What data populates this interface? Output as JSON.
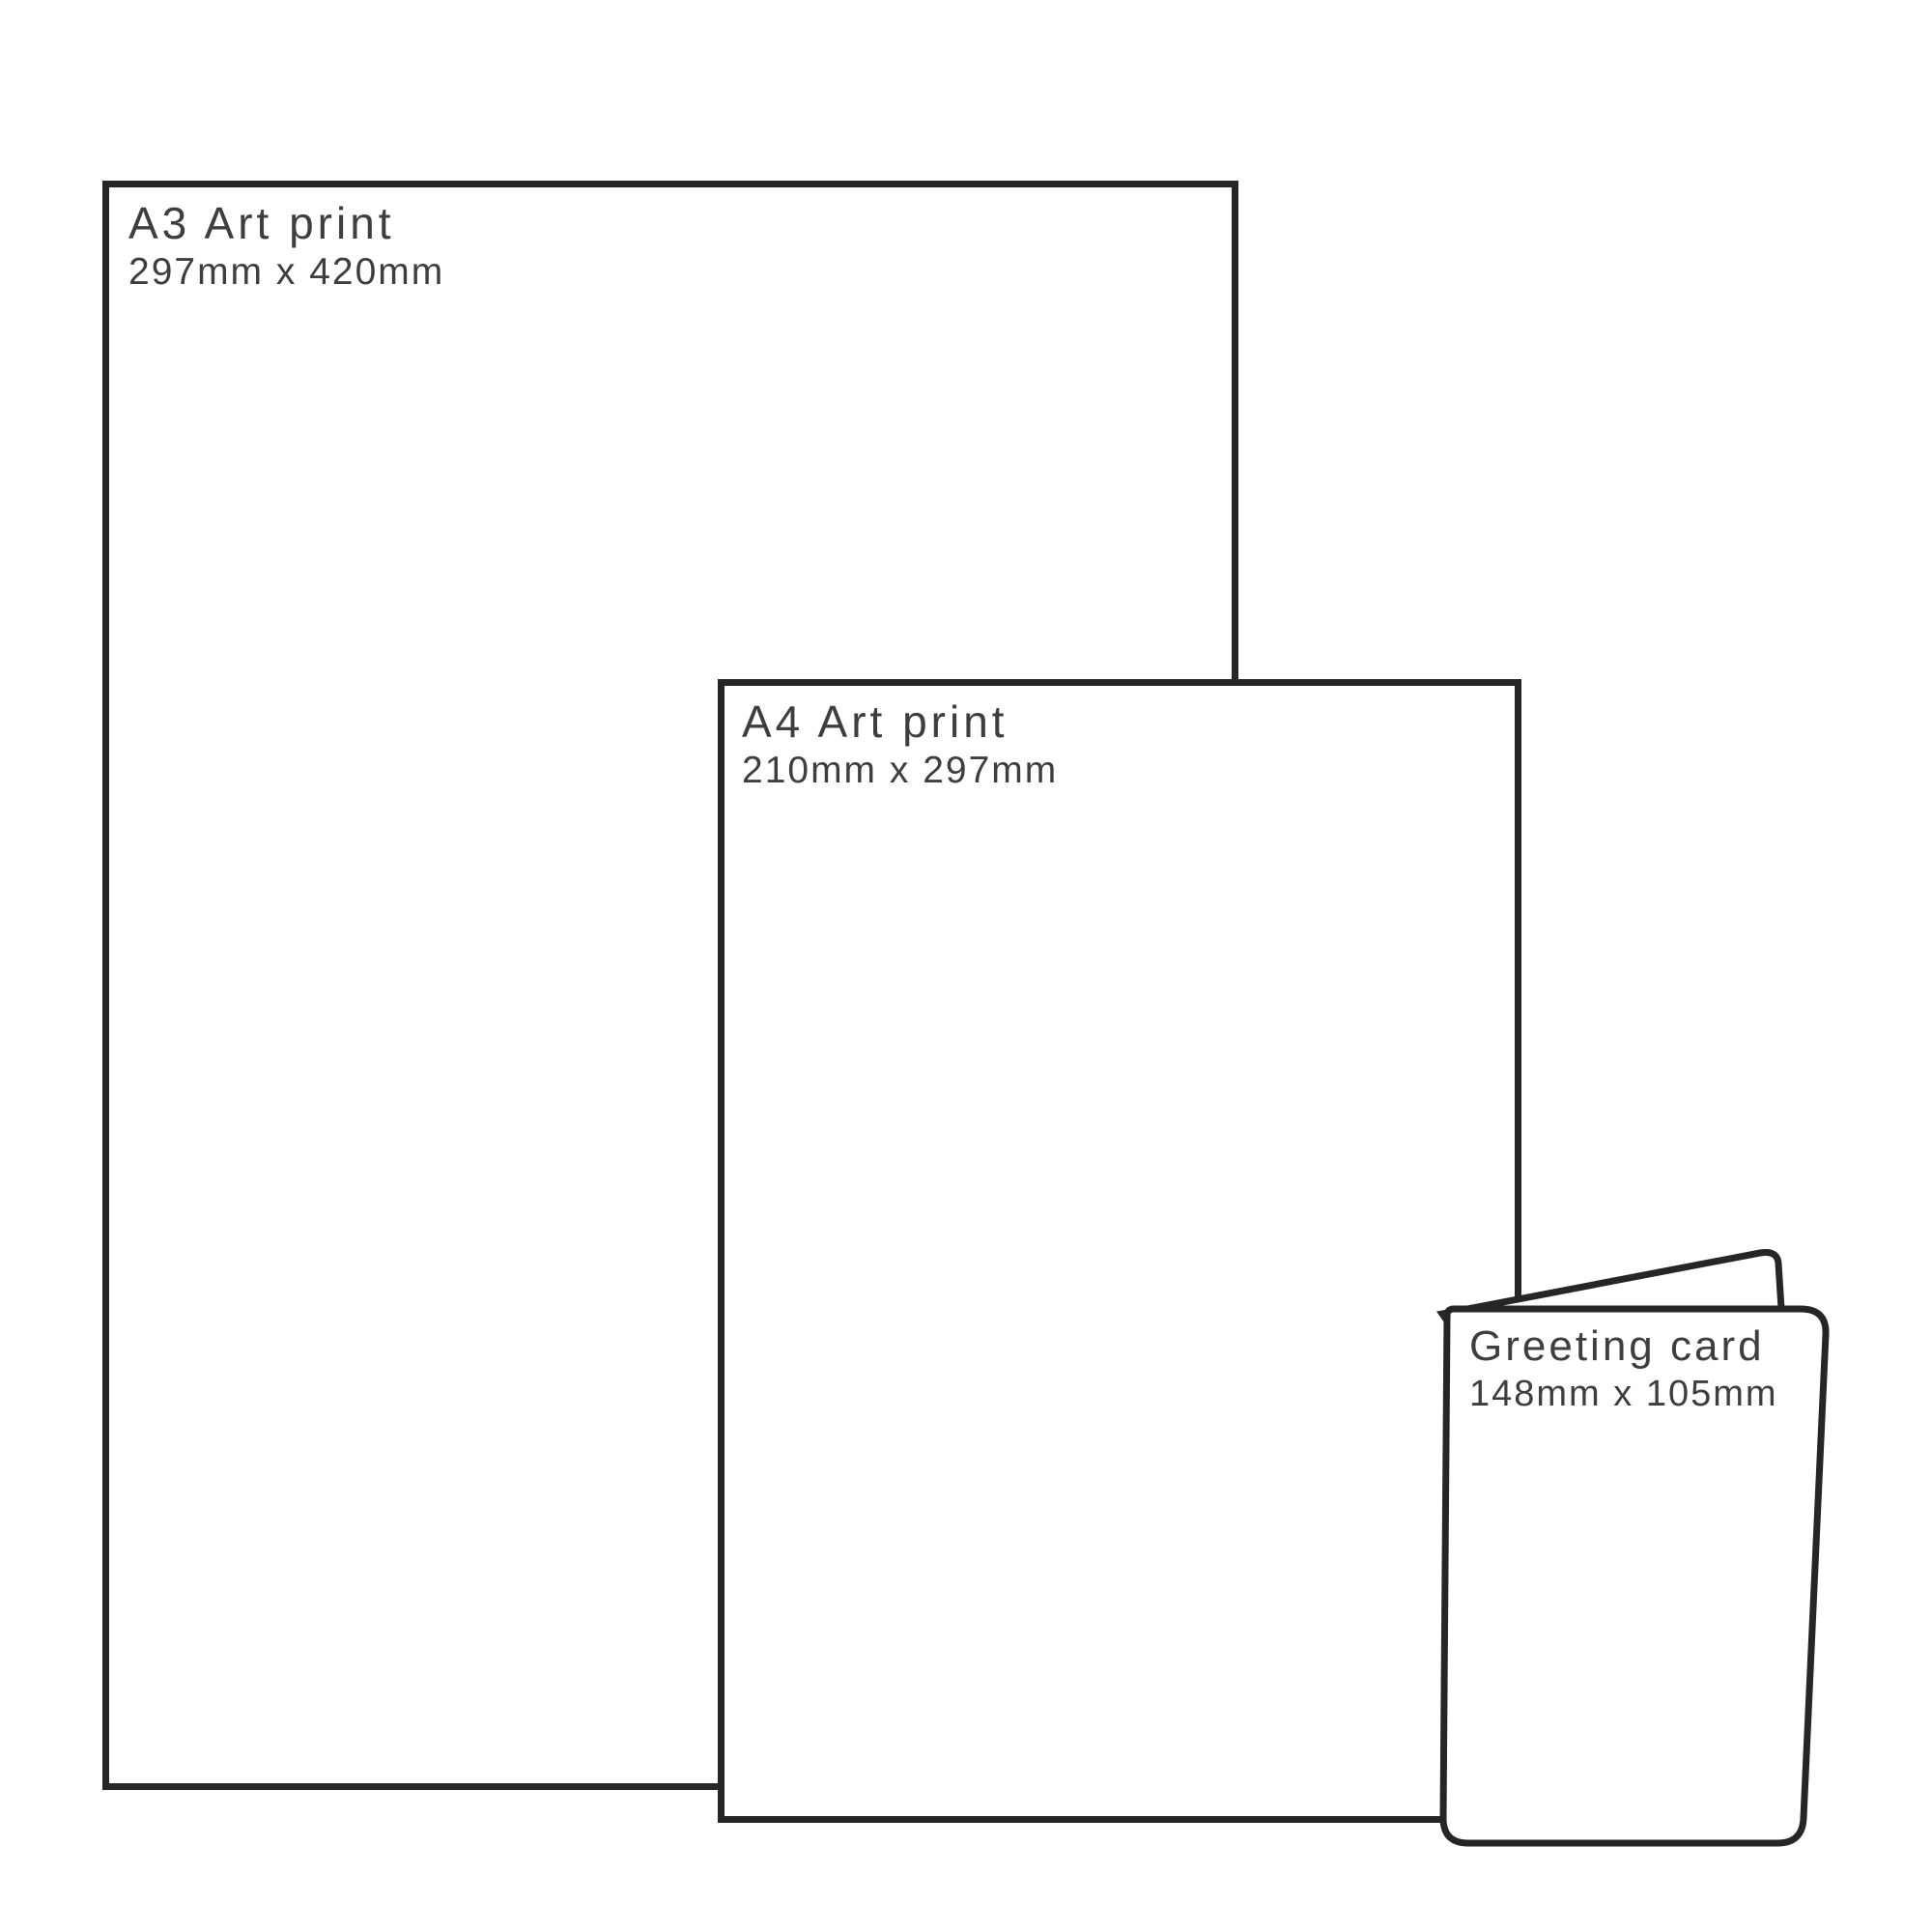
{
  "items": {
    "a3": {
      "title": "A3 Art print",
      "dimensions": "297mm x 420mm"
    },
    "a4": {
      "title": "A4 Art print",
      "dimensions": "210mm x 297mm"
    },
    "card": {
      "title": "Greeting card",
      "dimensions": "148mm x 105mm"
    }
  },
  "colors": {
    "outline": "#262626",
    "text": "#3e3e3e",
    "background": "#ffffff"
  }
}
